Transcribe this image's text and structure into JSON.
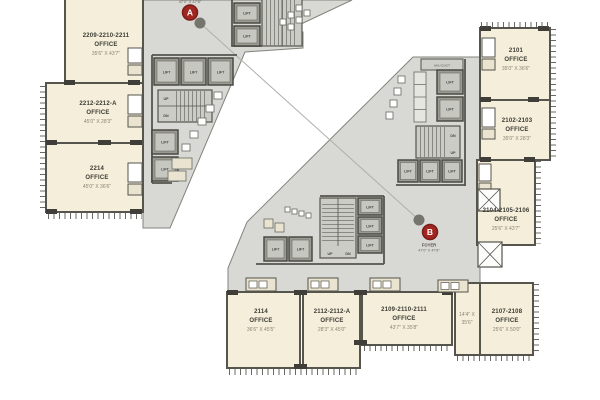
{
  "plan": {
    "markers": {
      "a": {
        "letter": "A",
        "partial_dims": "47'0\" X 47'8\""
      },
      "b": {
        "letter": "B",
        "foyer": "FOYER",
        "dims": "47'0\" X 47'8\""
      }
    },
    "core": {
      "lift": "LIFT",
      "up": "UP",
      "dn": "DN",
      "ahu": "AHU DUCT"
    },
    "offices": [
      {
        "id": "2209-2210-2211",
        "type": "OFFICE",
        "dims": "35'6\" X 43'7\""
      },
      {
        "id": "2212-2212-A",
        "type": "OFFICE",
        "dims": "45'0\" X 28'3\""
      },
      {
        "id": "2214",
        "type": "OFFICE",
        "dims": "45'0\" X 36'6\""
      },
      {
        "id": "2101",
        "type": "OFFICE",
        "dims": "35'0\" X 36'6\""
      },
      {
        "id": "2102-2103",
        "type": "OFFICE",
        "dims": "35'0\" X 28'3\""
      },
      {
        "id": "2104-2105-2106",
        "type": "OFFICE",
        "dims": "25'6\" X 43'7\""
      },
      {
        "id": "2107-2108",
        "type": "OFFICE",
        "dims": "25'6\" X 50'0\""
      },
      {
        "id": "2114",
        "type": "OFFICE",
        "dims": "36'6\" X 45'5\""
      },
      {
        "id": "2112-2112-A",
        "type": "OFFICE",
        "dims": "28'3\" X 45'0\""
      },
      {
        "id": "2109-2110-2111",
        "type": "OFFICE",
        "dims": "43'7\" X 35'8\""
      }
    ],
    "small_room": {
      "dims_line1": "14'4\" X",
      "dims_line2": "35'6\""
    },
    "colors": {
      "office": "#f4eeda",
      "core": "#d8d8d4",
      "wall": "#55544d",
      "marker": "#a02621"
    }
  }
}
